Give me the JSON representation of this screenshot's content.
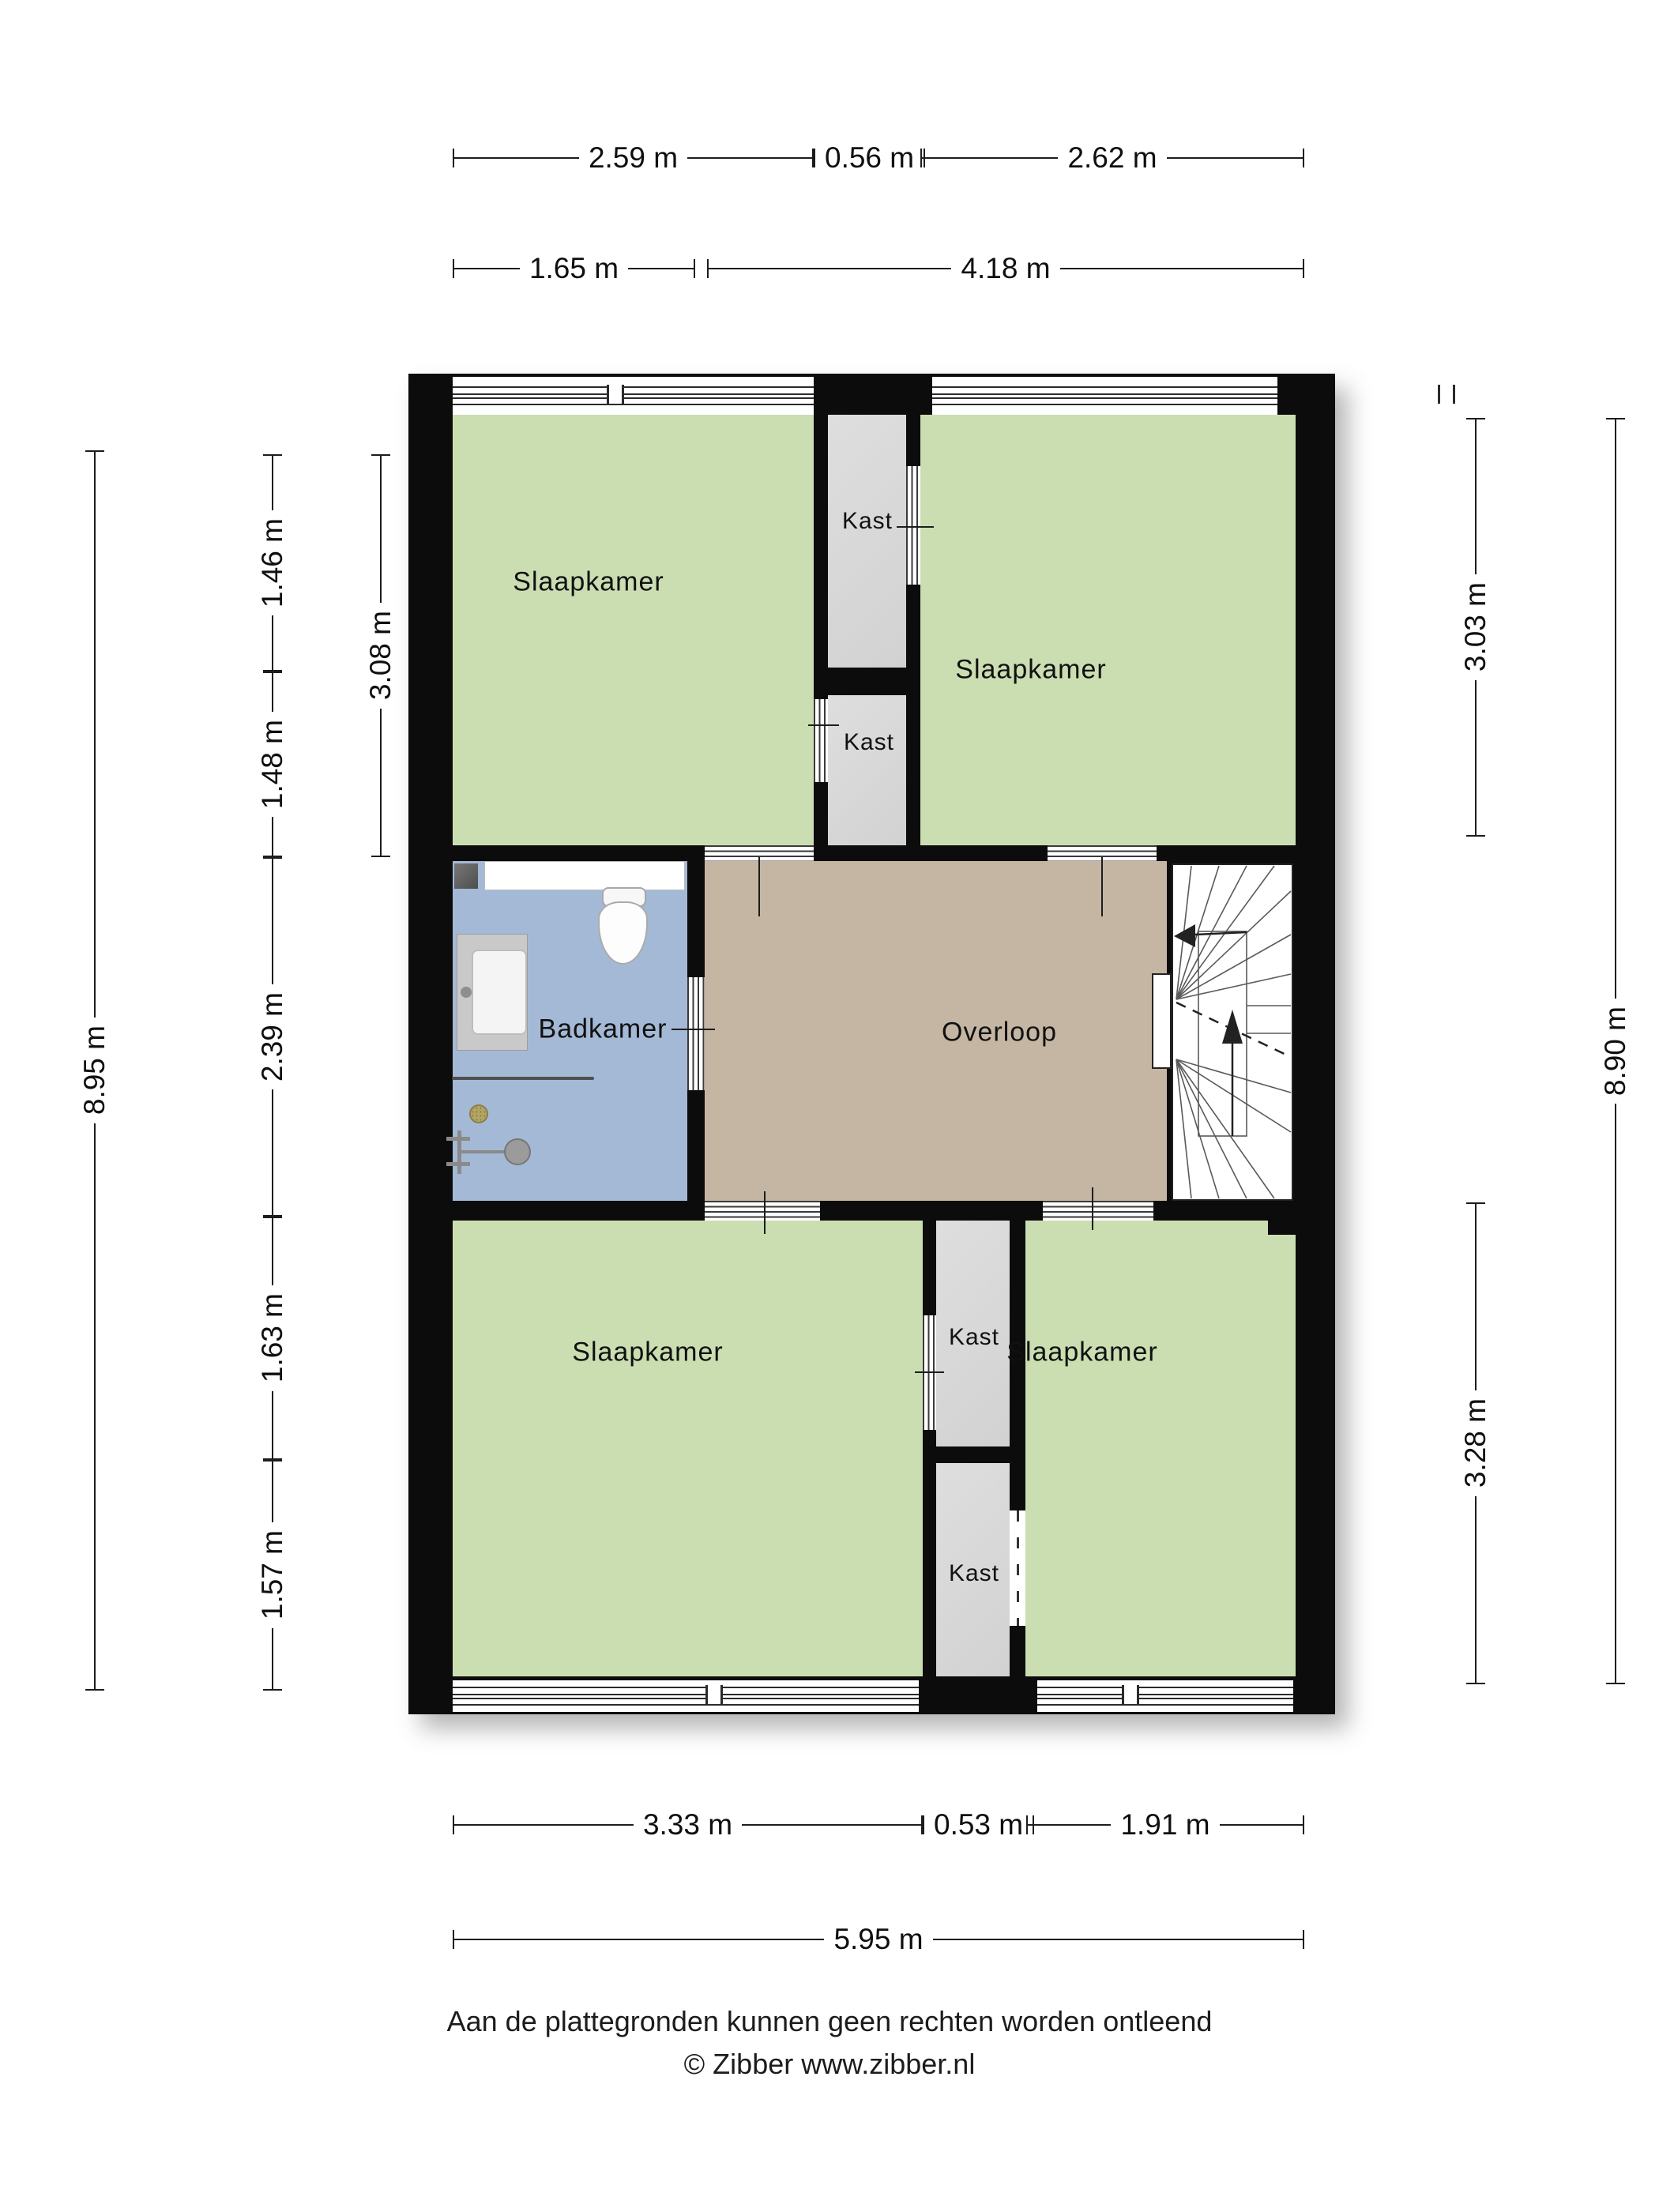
{
  "rooms": {
    "top_left": {
      "label": "Slaapkamer"
    },
    "top_right": {
      "label": "Slaapkamer"
    },
    "bottom_left": {
      "label": "Slaapkamer"
    },
    "bottom_right": {
      "label": "Slaapkamer"
    },
    "bathroom": {
      "label": "Badkamer"
    },
    "landing": {
      "label": "Overloop"
    },
    "closet_top_upper": {
      "label": "Kast"
    },
    "closet_top_lower": {
      "label": "Kast"
    },
    "closet_bottom_upper": {
      "label": "Kast"
    },
    "closet_bottom_lower": {
      "label": "Kast"
    }
  },
  "dims": {
    "top_row_outer": [
      "2.59 m",
      "0.56 m",
      "2.62 m"
    ],
    "top_row_inner": [
      "1.65 m",
      "4.18 m"
    ],
    "left_outer": "8.95 m",
    "left_mid": "3.08 m",
    "left_inner": [
      "1.46 m",
      "1.48 m",
      "2.39 m",
      "1.63 m",
      "1.57 m"
    ],
    "right_inner": [
      "3.03 m",
      "3.28 m"
    ],
    "right_outer": "8.90 m",
    "bottom_inner": [
      "3.33 m",
      "0.53 m",
      "1.91 m"
    ],
    "bottom_outer": "5.95 m"
  },
  "footer": {
    "disclaimer": "Aan de plattegronden kunnen geen rechten worden ontleend",
    "credit": "© Zibber www.zibber.nl"
  },
  "colors": {
    "wall": "#0c0c0c",
    "bedroom_fill": "#cbdeb2",
    "bathroom_fill": "#a4b9d6",
    "landing_fill": "#c5b6a4",
    "closet_fill": "#d7d7d7"
  }
}
